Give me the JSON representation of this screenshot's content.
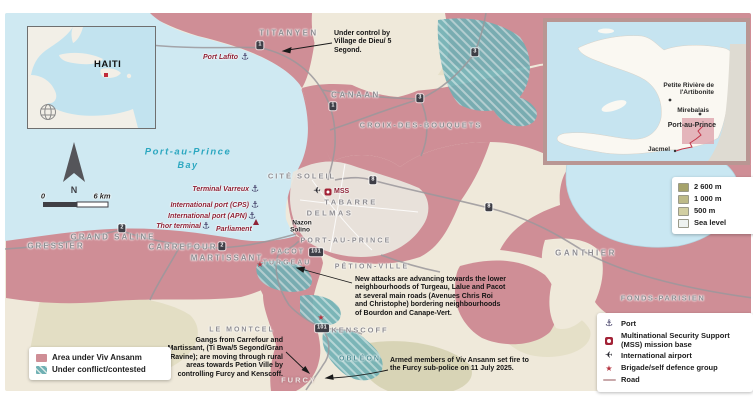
{
  "inset_caribbean": {
    "title": "HAITI"
  },
  "inset_haiti": {
    "labels": [
      "Petite Rivière de l'Artibonite",
      "Mirebalais",
      "Port-au-Prince",
      "Jacmel"
    ]
  },
  "compass": {
    "north": "N"
  },
  "scalebar": {
    "start": "0",
    "end": "6 km"
  },
  "water": {
    "bay_line1": "Port-au-Prince",
    "bay_line2": "Bay"
  },
  "area_labels": [
    "TITANYEN",
    "CANAAN",
    "CROIX-DES-BOUQUETS",
    "CITÉ SOLEIL",
    "TABARRE",
    "DELMAS",
    "PORT-AU-PRINCE",
    "PÉTION-VILLE",
    "GRAND SALINE",
    "GRESSIER",
    "CARREFOUR",
    "MARTISSANT",
    "PACOT",
    "TURGEAU",
    "GANTHIER",
    "FONDS-PARISIEN",
    "LE MONTCEL",
    "KENSCOFF",
    "OBLÉON",
    "FURCY"
  ],
  "town_labels": [
    "Nazon",
    "Solino"
  ],
  "poi": {
    "port_lafito": "Port Lafito",
    "terminal_varreux": "Terminal Varreux",
    "intl_port_cps": "International port (CPS)",
    "intl_port_apn": "International port (APN)",
    "thor_terminal": "Thor terminal",
    "parliament": "Parliament",
    "mss": "MSS"
  },
  "route_markers": [
    "1",
    "3",
    "3",
    "1",
    "8",
    "8",
    "2",
    "2",
    "101",
    "101"
  ],
  "annotations": [
    "Under control by Village de Dieu/ 5 Segond.",
    "New attacks are advancing towards the lower neighbourhoods of Turgeau, Lalue and Pacot at several main roads (Avenues Chris Roi and Christophe) bordering neighbourhoods of Bourdon and Canape-Vert.",
    "Gangs from Carrefour and Martissant, (Ti Bwa/5 Segond/Gran Ravine); are moving through rural areas towards Petion Ville by controlling Furcy and Kenscoff.",
    "Armed members of Viv Ansanm set fire to the Furcy sub-police on 11 July 2025."
  ],
  "legend_area": {
    "items": [
      {
        "label": "Area under Viv Ansanm"
      },
      {
        "label": "Under conflict/contested"
      }
    ]
  },
  "legend_symbols": {
    "items": [
      {
        "label": "Port"
      },
      {
        "label": "Multinational Security Support (MSS) mission base"
      },
      {
        "label": "International airport"
      },
      {
        "label": "Brigade/self defence group"
      },
      {
        "label": "Road"
      }
    ]
  },
  "legend_elevation": {
    "items": [
      {
        "label": "2 600 m"
      },
      {
        "label": "1 000 m"
      },
      {
        "label": "500 m"
      },
      {
        "label": "Sea level"
      }
    ]
  },
  "colors": {
    "viv_ansanm": "#cf8e96",
    "contested": "#6fb0b4",
    "water": "#cfe9f2",
    "land": "#efe9da",
    "port_label": "#8e2236",
    "mss_red": "#a32337",
    "star_red": "#b5333f",
    "road": "#9b989c"
  }
}
